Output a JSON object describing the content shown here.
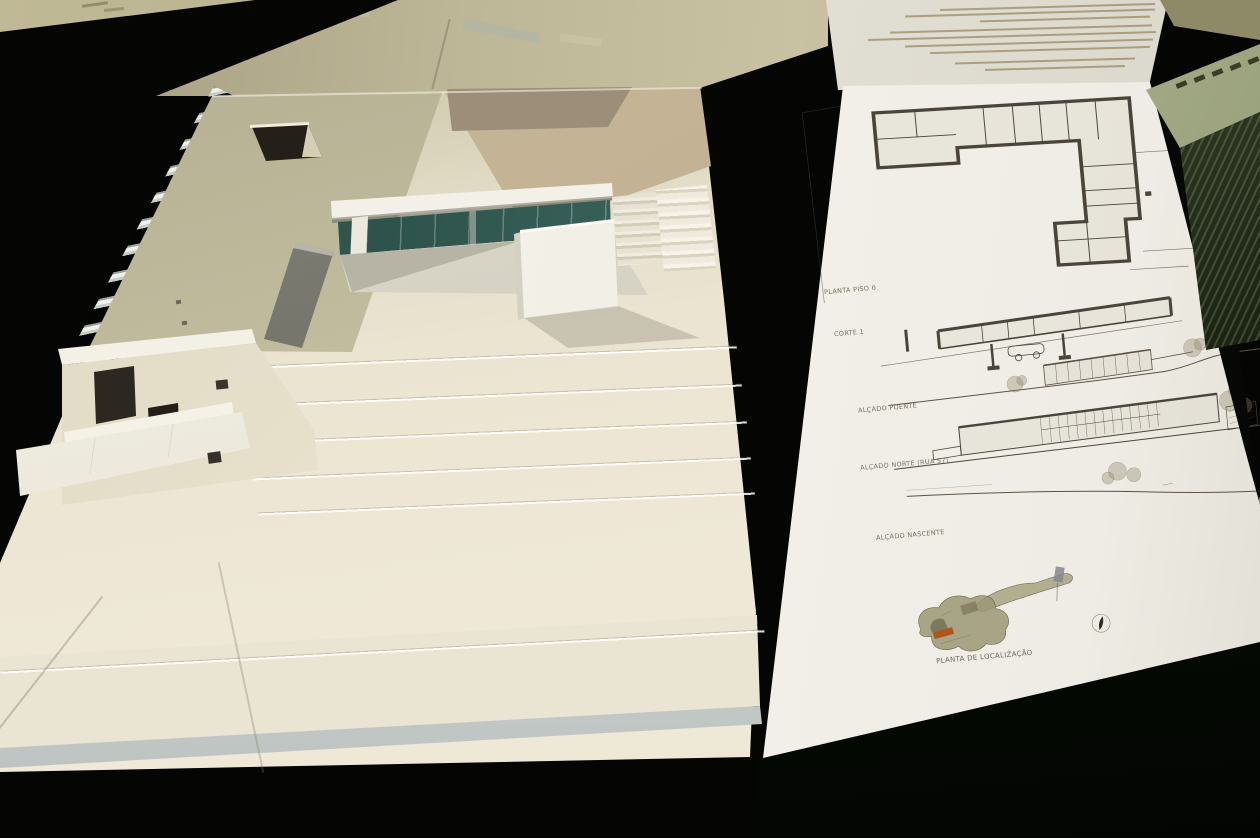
{
  "board": {
    "labels": {
      "floor_plan": "PLANTA PISO 0",
      "section": "CORTE 1",
      "elevation_west": "ALÇADO POENTE",
      "elevation_north": "ALÇADO NORTE (RUA 57)",
      "elevation_east": "ALÇADO NASCENTE",
      "location_plan": "PLANTA DE LOCALIZAÇÃO"
    }
  },
  "colors": {
    "table": "#060605",
    "model_card": "#ece5d3",
    "roof_olive": "#c0ba9d",
    "roof_tan": "#c2b193",
    "glazing_teal": "#35595a",
    "board_paper": "#f0eee6",
    "drawing_ink": "#4b443a",
    "site_highlight_orange": "#ad571d",
    "stack_green": "#36422a"
  }
}
